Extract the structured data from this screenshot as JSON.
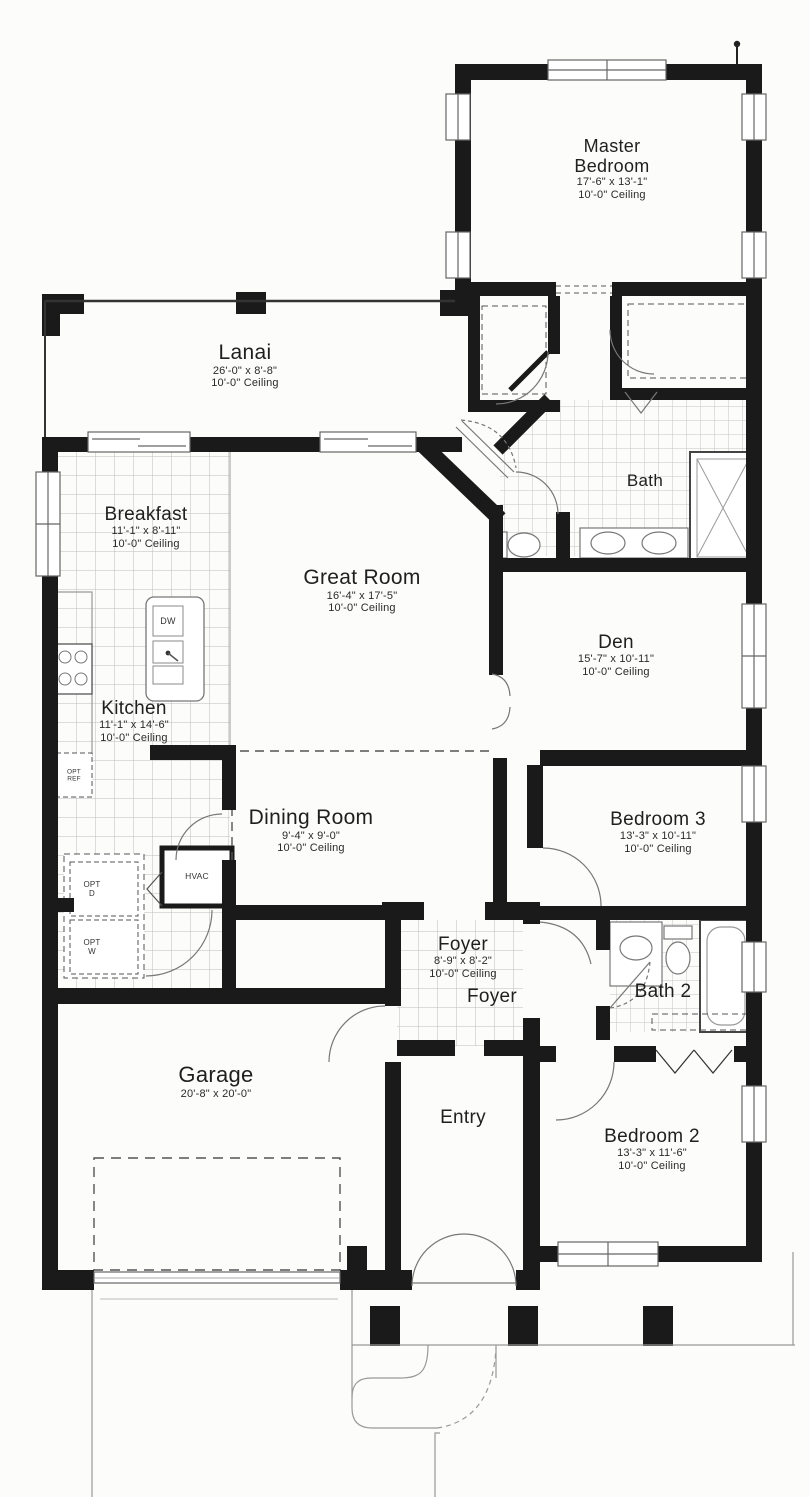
{
  "plan": {
    "rooms": {
      "master": {
        "name": "Master Bedroom",
        "dims": "17'-6\" x 13'-1\"",
        "ceiling": "10'-0\" Ceiling"
      },
      "lanai": {
        "name": "Lanai",
        "dims": "26'-0\" x 8'-8\"",
        "ceiling": "10'-0\" Ceiling"
      },
      "breakfast": {
        "name": "Breakfast",
        "dims": "11'-1\" x 8'-11\"",
        "ceiling": "10'-0\" Ceiling"
      },
      "great": {
        "name": "Great Room",
        "dims": "16'-4\" x 17'-5\"",
        "ceiling": "10'-0\" Ceiling"
      },
      "bath": {
        "name": "Bath"
      },
      "den": {
        "name": "Den",
        "dims": "15'-7\" x 10'-11\"",
        "ceiling": "10'-0\" Ceiling"
      },
      "kitchen": {
        "name": "Kitchen",
        "dims": "11'-1\" x 14'-6\"",
        "ceiling": "10'-0\" Ceiling"
      },
      "dining": {
        "name": "Dining Room",
        "dims": "9'-4\" x 9'-0\"",
        "ceiling": "10'-0\" Ceiling"
      },
      "bedroom3": {
        "name": "Bedroom 3",
        "dims": "13'-3\" x 10'-11\"",
        "ceiling": "10'-0\" Ceiling"
      },
      "foyer": {
        "name": "Foyer",
        "dims": "8'-9\" x 8'-2\"",
        "ceiling": "10'-0\" Ceiling"
      },
      "foyer2": {
        "name": "Foyer"
      },
      "bath2": {
        "name": "Bath 2"
      },
      "garage": {
        "name": "Garage",
        "dims": "20'-8\" x 20'-0\""
      },
      "entry": {
        "name": "Entry"
      },
      "bedroom2": {
        "name": "Bedroom 2",
        "dims": "13'-3\" x 11'-6\"",
        "ceiling": "10'-0\" Ceiling"
      }
    },
    "appliances": {
      "dishwasher": "DW",
      "opt_ref": "OPT REF",
      "opt_dryer": "OPT D",
      "opt_washer": "OPT W",
      "hvac": "HVAC"
    },
    "colors": {
      "wall": "#1a1a1a",
      "line": "#777777",
      "tile": "#b9b9b9",
      "text": "#1f1f1f"
    }
  }
}
